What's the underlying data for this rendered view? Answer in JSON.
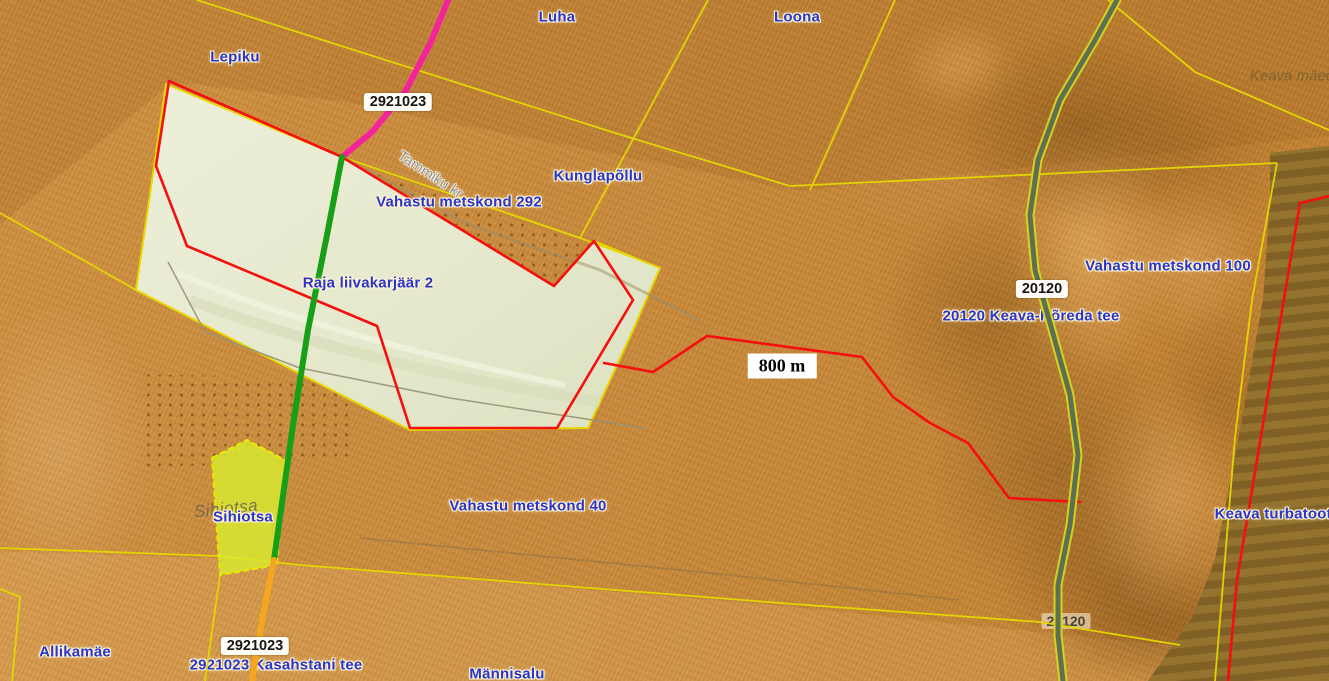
{
  "map": {
    "description": "Orange hillshade cadastral web-map of the Keava / Vahastu area (Estonia) with parcel boundaries, road lines and place labels",
    "scale_annotation": "800 m",
    "palette": {
      "terrain_orange": "#c8893a",
      "quarry_pale": "#e8ebd2",
      "highlight_parcel_green": "#d8e830",
      "peat_brown": "#8b6b2c",
      "cadastral_yellow": "#e6d800",
      "boundary_red": "#f50f0f",
      "road_magenta": "#f5239b",
      "road_green": "#17a017",
      "road_orange": "#f5a61e",
      "road_20120_edge": "#d8d61e",
      "road_20120_fill": "#5d7052",
      "label_blue": "#2a35cb",
      "label_halo": "#fdf3cf"
    },
    "labels": [
      {
        "name": "label-lepiku",
        "text": "Lepiku",
        "x": 235,
        "y": 57,
        "cls": "place"
      },
      {
        "name": "label-luha",
        "text": "Luha",
        "x": 557,
        "y": 17,
        "cls": "place"
      },
      {
        "name": "label-loona",
        "text": "Loona",
        "x": 797,
        "y": 17,
        "cls": "place"
      },
      {
        "name": "label-kunglapollu",
        "text": "Kunglapõllu",
        "x": 598,
        "y": 176,
        "cls": "place"
      },
      {
        "name": "label-vahastu-metskond-292",
        "text": "Vahastu metskond 292",
        "x": 459,
        "y": 202,
        "cls": "place"
      },
      {
        "name": "label-raja-liivakarjaar-2",
        "text": "Raja liivakarjäär 2",
        "x": 368,
        "y": 283,
        "cls": "place"
      },
      {
        "name": "label-tammiku-kr",
        "text": "Tammiku kr",
        "x": 430,
        "y": 175,
        "cls": "track-name",
        "rot": 33
      },
      {
        "name": "road-number-badge-2921023-top",
        "text": "2921023",
        "x": 398,
        "y": 102,
        "cls": "badge"
      },
      {
        "name": "distance-annotation-800m",
        "text": "800 m",
        "x": 782,
        "y": 366,
        "cls": "scale"
      },
      {
        "name": "road-number-badge-20120",
        "text": "20120",
        "x": 1042,
        "y": 289,
        "cls": "badge"
      },
      {
        "name": "label-keava-horeda-tee",
        "text": "20120 Keava-Hõreda tee",
        "x": 1031,
        "y": 316,
        "cls": "place",
        "layer": "under"
      },
      {
        "name": "label-vahastu-metskond-100",
        "text": "Vahastu metskond 100",
        "x": 1168,
        "y": 266,
        "cls": "place"
      },
      {
        "name": "label-keava-maed",
        "text": "Keava mäed",
        "x": 1292,
        "y": 76,
        "cls": "italic-gray"
      },
      {
        "name": "label-vahastu-metskond-40",
        "text": "Vahastu metskond 40",
        "x": 528,
        "y": 506,
        "cls": "place"
      },
      {
        "name": "label-sihiotsa-terrain",
        "text": "Sihiotsa",
        "x": 226,
        "y": 509,
        "cls": "italic-gray2",
        "rot": -6
      },
      {
        "name": "label-sihiotsa",
        "text": "Sihiotsa",
        "x": 243,
        "y": 517,
        "cls": "place"
      },
      {
        "name": "label-allikamae",
        "text": "Allikamäe",
        "x": 75,
        "y": 652,
        "cls": "place"
      },
      {
        "name": "road-number-badge-2921023-bottom",
        "text": "2921023",
        "x": 255,
        "y": 646,
        "cls": "badge"
      },
      {
        "name": "label-kasahstani-tee",
        "text": "2921023 Kasahstani tee",
        "x": 276,
        "y": 665,
        "cls": "place",
        "layer": "under"
      },
      {
        "name": "label-mannisalu",
        "text": "Männisalu",
        "x": 507,
        "y": 674,
        "cls": "place"
      },
      {
        "name": "label-keava-turbatootmisala",
        "text": "Keava turbatootm",
        "x": 1280,
        "y": 514,
        "cls": "place"
      },
      {
        "name": "road-number-badge-20120-faint",
        "text": "20120",
        "x": 1066,
        "y": 621,
        "cls": "badge-faint",
        "layer": "under"
      }
    ]
  }
}
